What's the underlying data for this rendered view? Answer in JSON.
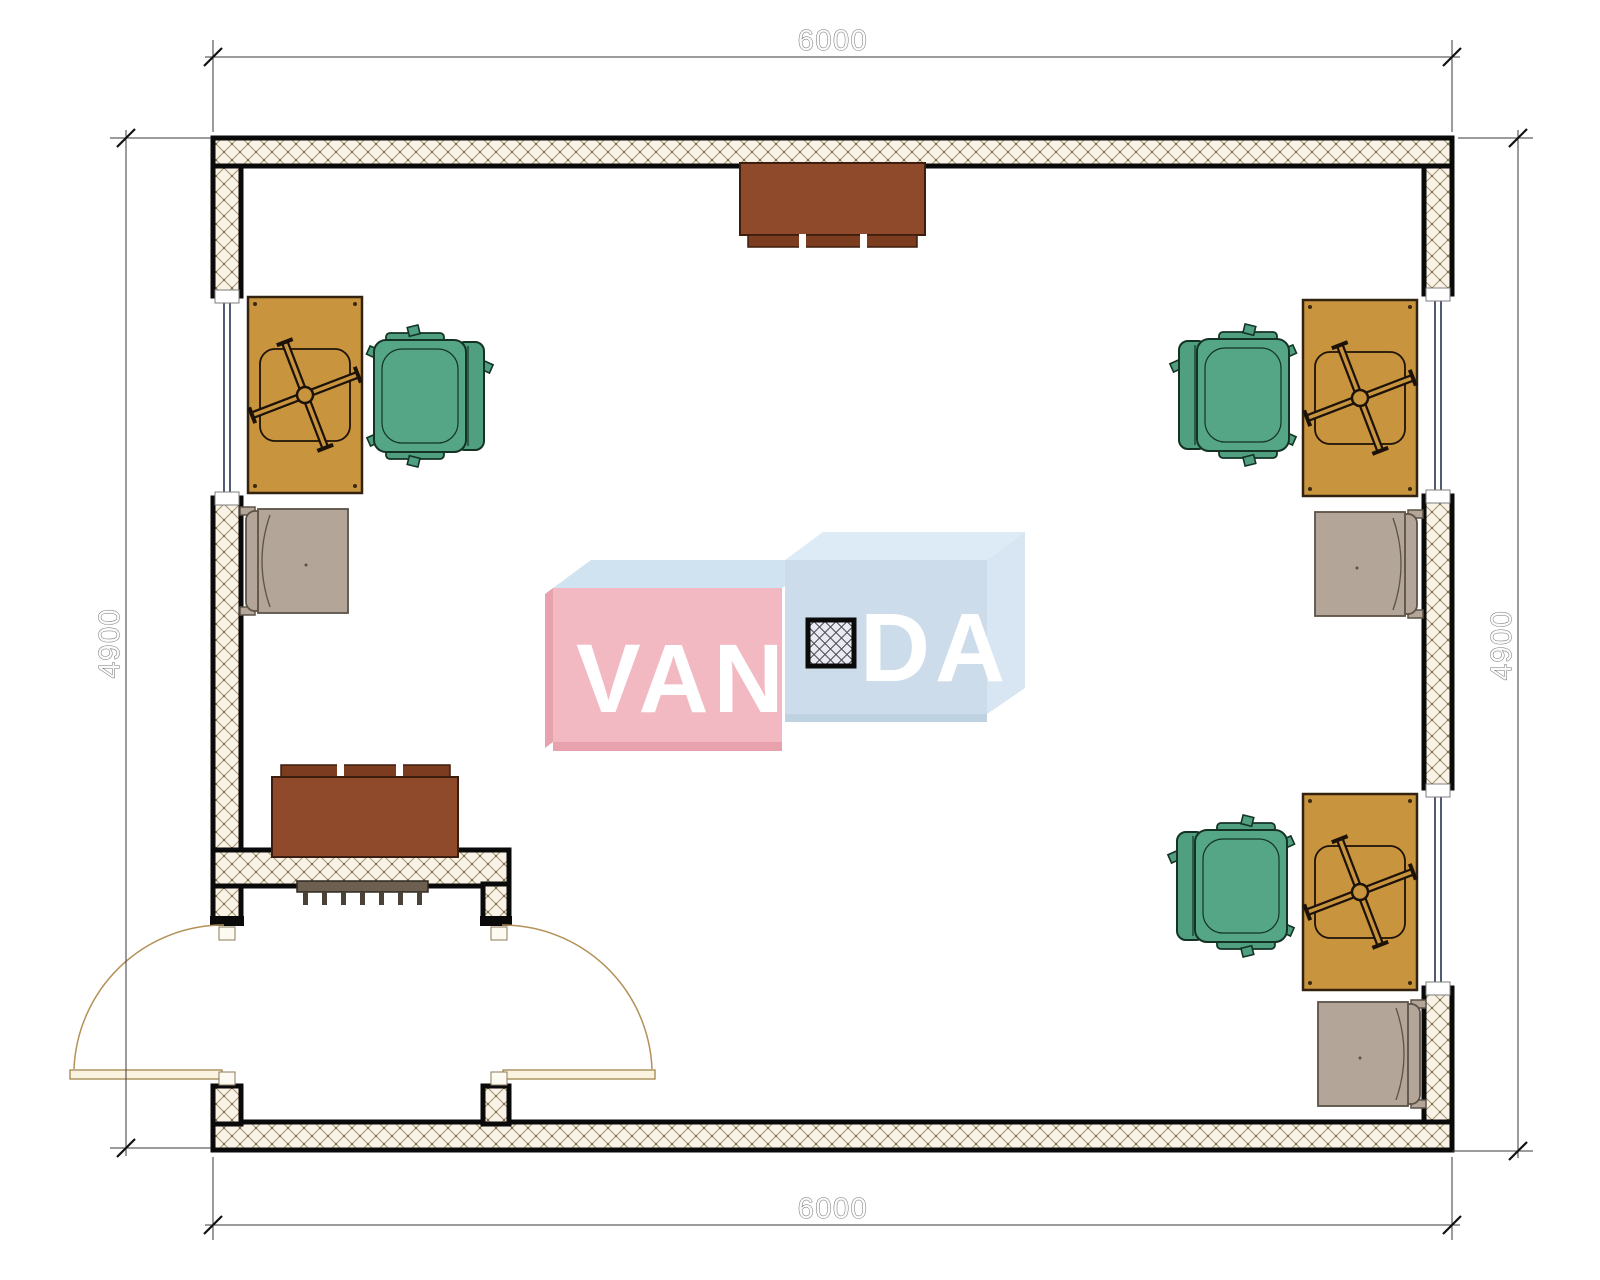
{
  "page": {
    "background": "#ffffff"
  },
  "plan": {
    "type": "office-floor-plan",
    "dimensions": {
      "top": "6000",
      "bottom": "6000",
      "left": "4900",
      "right": "4900"
    },
    "watermark": {
      "part1": "VAN",
      "part2": "DA",
      "full_text": "VANDA",
      "pink_face": "#f2b9c2",
      "pink_shade": "#e7a2ae",
      "blue_face": "#ccdcea",
      "blue_top": "#dcebf5",
      "top_face_left": "#cfe3f0"
    },
    "colors": {
      "wall_hatch_bg": "#f8f3e6",
      "wall_hatch_line": "#a3946f",
      "wall_border": "#0a0a0a",
      "desk": "#c8943e",
      "office_chair": "#55a587",
      "visitor_chair": "#b3a698",
      "cabinet": "#8e4a2b",
      "cabinet_strip": "#7c3c20",
      "radiator": "#6e6050",
      "door_leaf": "#faf3df",
      "door_arc": "#b39158",
      "window_glazing": "#26324f",
      "dimension_text": "#6e6e6e"
    },
    "furniture": {
      "desks": 3,
      "office_chairs": 3,
      "visitor_chairs": 3,
      "cabinets": 2,
      "radiators": 1,
      "columns": 1,
      "windows": 3,
      "entry": "double-swing-door"
    }
  }
}
